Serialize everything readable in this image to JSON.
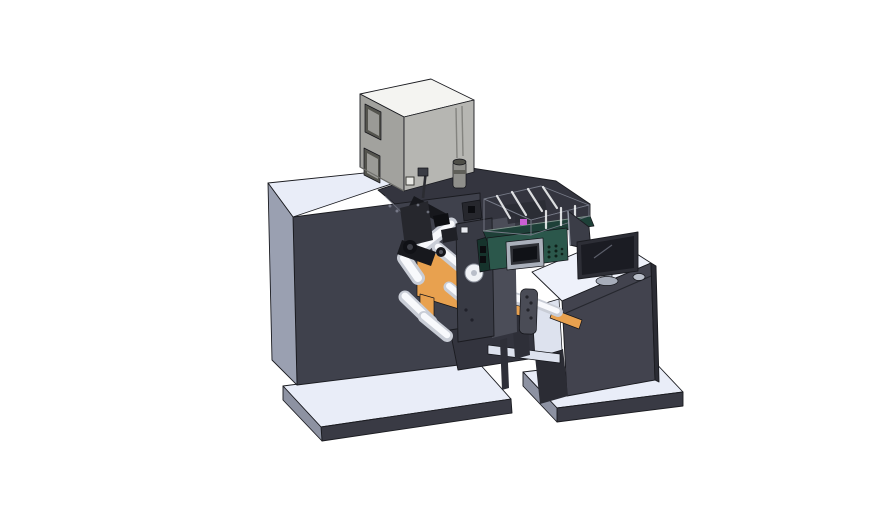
{
  "scene": {
    "type": "3d-cad-render",
    "description": "Isometric CAD render of a label printing/rewinding machine line: dryer box on top of a dark cabinet, unwind station with orange plates and guide rollers, green coder unit with display under a translucent safety cover, infeed conveyor, and an operator desk with monitor, rear panel and mouse on light base platforms.",
    "background": "#ffffff",
    "parts": [
      "base-platform-left",
      "base-platform-right",
      "machine-deck",
      "print-housing",
      "dryer-box",
      "power-knob",
      "cabinet-front-panel",
      "cabinet-left-panel",
      "unwind-station",
      "orange-plate",
      "guide-rollers",
      "station-front-plate",
      "web-mechanism",
      "infeed-conveyor",
      "sensor-handle",
      "ink-coder-unit",
      "coder-display",
      "safety-cover",
      "operator-desk",
      "desk-shelf",
      "rear-panel",
      "monitor",
      "monitor-stand",
      "mouse"
    ]
  },
  "colors": {
    "bg": "#ffffff",
    "deckTop": "#e9edf8",
    "platformTop": "#e9edf8",
    "platformFront": "#393a44",
    "platformLeft": "#8d92a2",
    "cabinetFront": "#3f414c",
    "cabinetLeft": "#9aa0b1",
    "housingDark": "#34353f",
    "bridgeDark": "#33343e",
    "boxTop": "#f4f4f1",
    "boxLeft": "#a2a29e",
    "boxFront": "#b6b6b2",
    "boxInset": "#54544e",
    "boxInsetPanel": "#9a9a96",
    "knobBody": "#8f8f8b",
    "knobDark": "#4e4e48",
    "orange": "#e8a14f",
    "orangeShade": "#c07c2c",
    "rollerLight": "#e8eaf0",
    "rollerCore": "#f8f9fc",
    "plateDark": "#383a44",
    "sideWall": "#4b4d58",
    "mechBlack": "#17181d",
    "mechGray": "#26272d",
    "mechLight": "#585a64",
    "greenFace": "#2b574b",
    "greenTop": "#1e4038",
    "greenSide": "#16332c",
    "displayFrame": "#aab0bb",
    "displayMid": "#2e3036",
    "displayScreen": "#101217",
    "ventDot": "#0f2019",
    "coverGlass": "rgba(205,212,224,0.52)",
    "coverGlassSide": "rgba(182,190,204,0.55)",
    "coverInner": "rgba(42,44,52,0.85)",
    "magenta": "#c95fd2",
    "deskTop": "#eef1fa",
    "deskFront": "#42434e",
    "deskSide": "#2b2c34",
    "interiorLight": "#dde2ee",
    "supportDark": "#2e2f38",
    "handleGray": "#4a4c56",
    "panelDark": "#3b3d47",
    "monitorBezel": "#2d2e36",
    "monitorScreen": "#1b1c23",
    "standGray": "#a7adba",
    "mouseGray": "#b9bec9",
    "circleLight": "#f0f2f6",
    "edge": "#1a1b20"
  }
}
